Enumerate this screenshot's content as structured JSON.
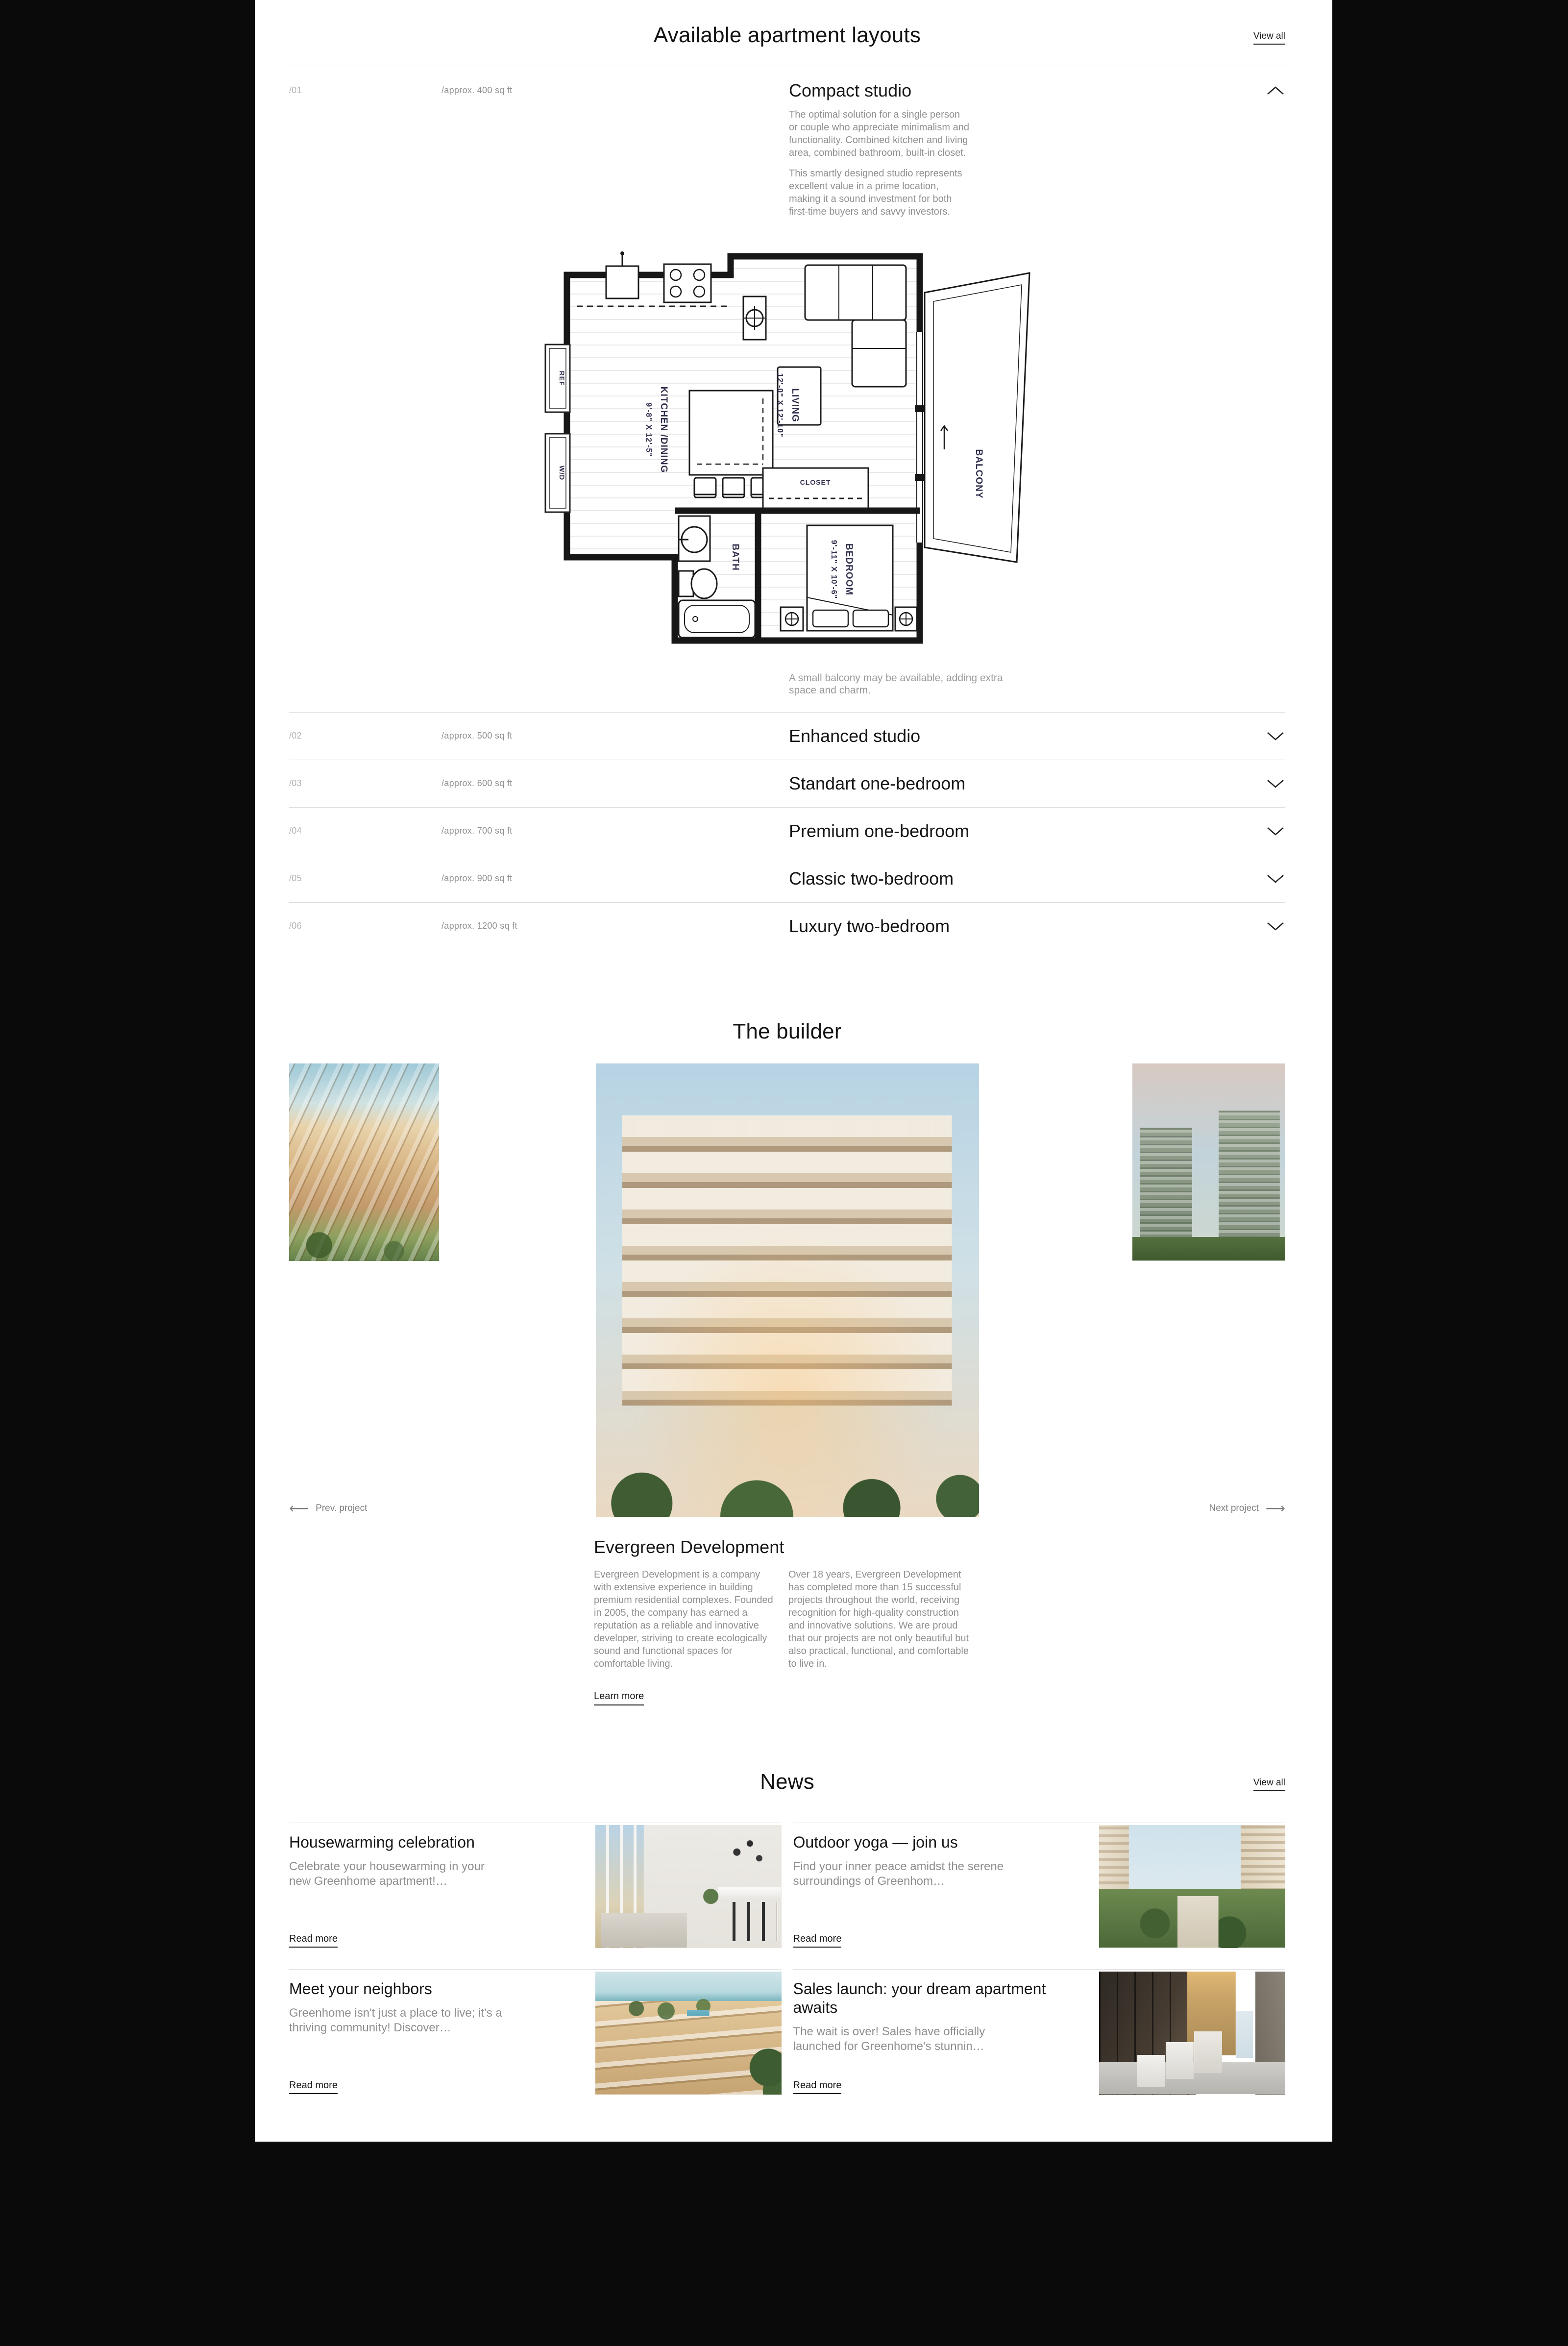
{
  "theme": {
    "background": "#0a0a0a",
    "panel": "#ffffff",
    "text": "#161616",
    "muted": "#8f8f8f",
    "faint": "#b3b3b3",
    "divider": "#dcdcdc",
    "plan_label": "#30304e"
  },
  "layouts_section": {
    "title": "Available apartment layouts",
    "view_all_label": "View all",
    "items": [
      {
        "num": "/01",
        "size": "/approx. 400 sq ft",
        "name": "Compact studio",
        "expanded": true,
        "paragraphs": [
          "The optimal solution for a single person or couple who appreciate minimalism and functionality. Combined kitchen and living area, combined bathroom, built-in closet.",
          "This smartly designed studio represents excellent value in a prime location, making it a sound investment for both first-time buyers and savvy investors."
        ],
        "caption": "A small balcony may be available, adding extra space and charm."
      },
      {
        "num": "/02",
        "size": "/approx. 500 sq ft",
        "name": "Enhanced studio",
        "expanded": false
      },
      {
        "num": "/03",
        "size": "/approx. 600 sq ft",
        "name": "Standart one-bedroom",
        "expanded": false
      },
      {
        "num": "/04",
        "size": "/approx. 700 sq ft",
        "name": "Premium one-bedroom",
        "expanded": false
      },
      {
        "num": "/05",
        "size": "/approx. 900 sq ft",
        "name": "Classic two-bedroom",
        "expanded": false
      },
      {
        "num": "/06",
        "size": "/approx. 1200 sq ft",
        "name": "Luxury two-bedroom",
        "expanded": false
      }
    ],
    "floor_plan": {
      "rooms": {
        "kitchen": "KITCHEN /DINING",
        "kitchen_dims": "9'-8\" X 12'-5\"",
        "living": "LIVING",
        "living_dims": "12'-0\" X 12'-10\"",
        "bedroom": "BEDROOM",
        "bedroom_dims": "9'-11\" X 10'-6\"",
        "bath": "BATH",
        "closet": "CLOSET",
        "ref": "REF",
        "wd": "W/D",
        "balcony": "BALCONY"
      }
    }
  },
  "builder_section": {
    "title": "The builder",
    "prev_arrow": "⟵",
    "prev_label": "Prev. project",
    "next_label": "Next project",
    "next_arrow": "⟶",
    "company": "Evergreen Development",
    "col1": "Evergreen Development is a company with extensive experience in building premium residential complexes. Founded in 2005, the company has earned a reputation as a reliable and innovative developer, striving to create ecologically sound and functional spaces for comfortable living.",
    "col2": "Over 18 years, Evergreen Development has completed more than 15 successful projects throughout the world, receiving recognition for high-quality construction and innovative solutions. We are proud that our projects are not only beautiful but also practical, functional, and comfortable to live in.",
    "learn_more_label": "Learn more"
  },
  "news_section": {
    "title": "News",
    "view_all_label": "View all",
    "read_more_label": "Read more",
    "articles": [
      {
        "title": "Housewarming celebration",
        "excerpt": "Celebrate your housewarming in your new Greenhome apartment!…"
      },
      {
        "title": "Outdoor yoga — join us",
        "excerpt": "Find your inner peace amidst the serene surroundings of Greenhom…"
      },
      {
        "title": "Meet your neighbors",
        "excerpt": "Greenhome isn't just a place to live; it's a thriving community! Discover…"
      },
      {
        "title": "Sales launch: your dream apartment awaits",
        "excerpt": "The wait is over! Sales have officially launched for Greenhome's stunnin…"
      }
    ]
  }
}
